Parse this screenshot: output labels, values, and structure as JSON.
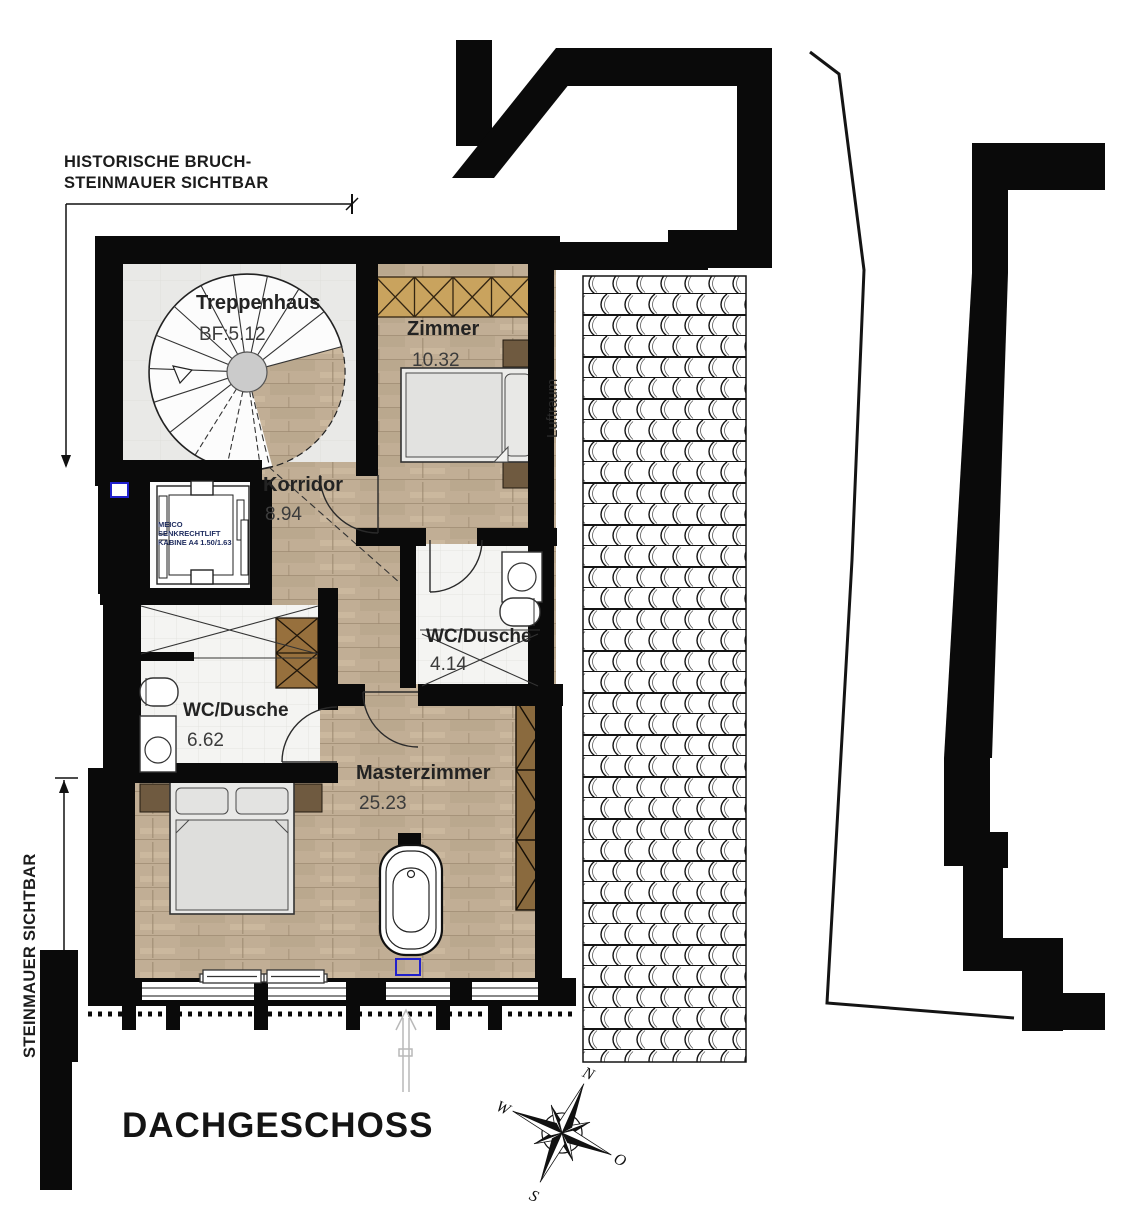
{
  "title": "DACHGESCHOSS",
  "annotations": {
    "historic_wall_l1": "HISTORISCHE BRUCH-",
    "historic_wall_l2": "STEINMAUER SICHTBAR",
    "stone_wall": "STEINMAUER SICHTBAR",
    "luftraum": "Luftraum"
  },
  "rooms": {
    "treppenhaus": {
      "name": "Treppenhaus",
      "area": "BF:5.12"
    },
    "zimmer": {
      "name": "Zimmer",
      "area": "10.32"
    },
    "korridor": {
      "name": "Korridor",
      "area": "8.94"
    },
    "wc_top": {
      "name": "WC/Dusche",
      "area": "4.14"
    },
    "wc_left": {
      "name": "WC/Dusche",
      "area": "6.62"
    },
    "master": {
      "name": "Masterzimmer",
      "area": "25.23"
    }
  },
  "lift": {
    "l1": "MEICO",
    "l2": "SENKRECHTLIFT",
    "l3": "KABINE A4 1.50/1.63"
  },
  "compass": {
    "north": "N",
    "east": "O",
    "south": "S",
    "west": "W"
  },
  "colors": {
    "wall": "#0a0a0a",
    "wood": "#c1ae95",
    "accent_blue": "#2020cc",
    "wardrobe_light": "#c9a35e",
    "wardrobe_dark": "#8a6a3e"
  }
}
